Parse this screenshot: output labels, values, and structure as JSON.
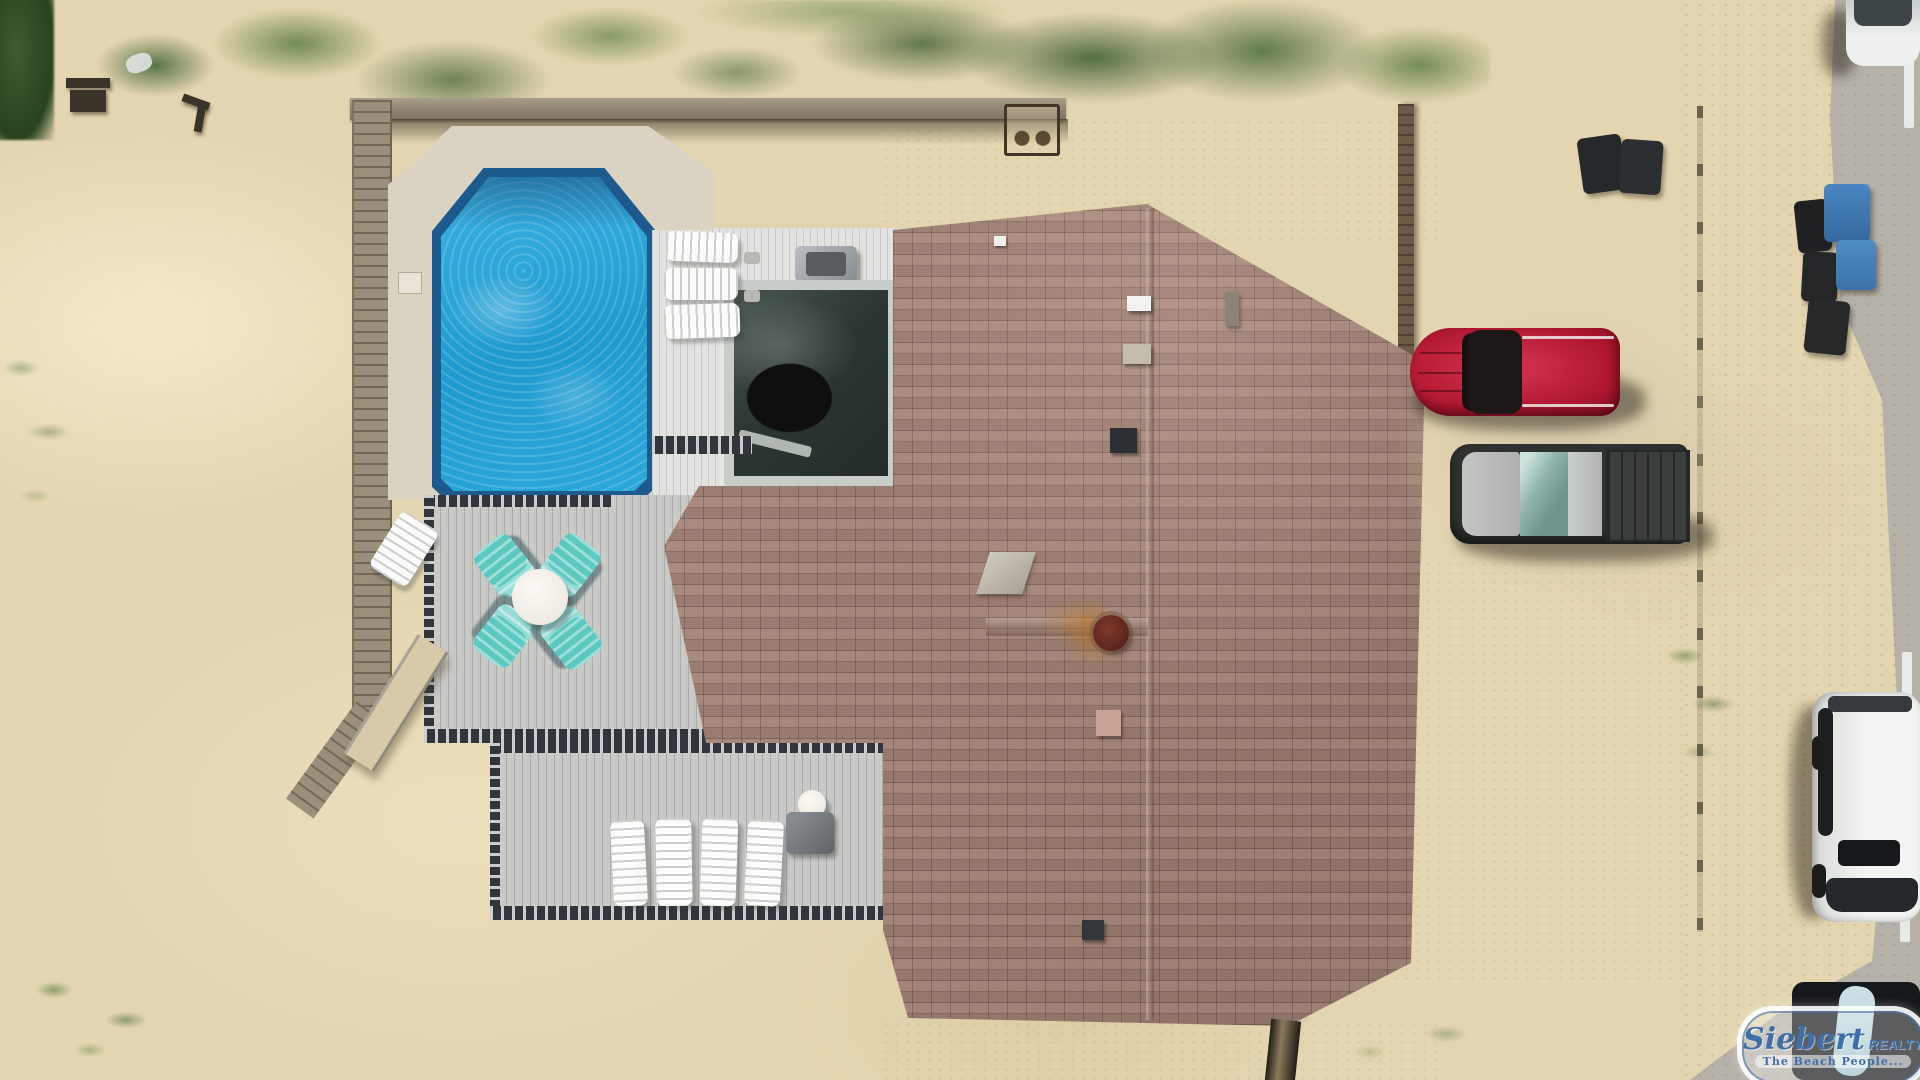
{
  "watermark": {
    "brand": "Siebert",
    "brand_suffix": "REALTY",
    "tagline": "The Beach People...",
    "logo_blue": "#3f6fa8"
  },
  "scene": {
    "type": "aerial-drone-photo",
    "description": "Top-down aerial view of an oceanfront beach house with swimming pool, wraparound gray deck, hot tub enclosure, sand dunes, dune fencing, and vehicles parked beside a road.",
    "objects": [
      "octagonal swimming pool with bright blue water",
      "concrete pool apron",
      "three white loungers beside pool",
      "dark screened hot tub enclosure",
      "stainless gas grill on upper deck",
      "gray composite deck with four teal adirondack chairs around a white round table",
      "lower deck with four white lounge chairs, round table and small grill",
      "wooden access ramp and boardwalk",
      "weathered dune fence with iron planter",
      "brown architectural-shingle hip roof",
      "rusted round chimney cap with rust stain",
      "roof vents and skylight",
      "red SUV parked facing left",
      "dark pickup truck with silver hood",
      "white SUV parked along road edge",
      "white car at top right on pavement",
      "black vehicle with light kayak at bottom right",
      "blue recycling bins and black trash bins",
      "wood bench and debris in sand",
      "dune grass and shrubs along top",
      "gray road with white edge line segments"
    ],
    "colors": {
      "sand": "#e3d5af",
      "concrete_apron": "#dad3c2",
      "deck": "#c9c9c5",
      "pool_water": "#2aa6d9",
      "pool_edge": "#1d5a8e",
      "roof_shingle": "#a98a7c",
      "teal_chair": "#5cc9c1",
      "red_suv": "#b01830",
      "truck_body": "#2e3330",
      "vegetation": "#55793c",
      "pavement": "#b6b1a8"
    }
  }
}
